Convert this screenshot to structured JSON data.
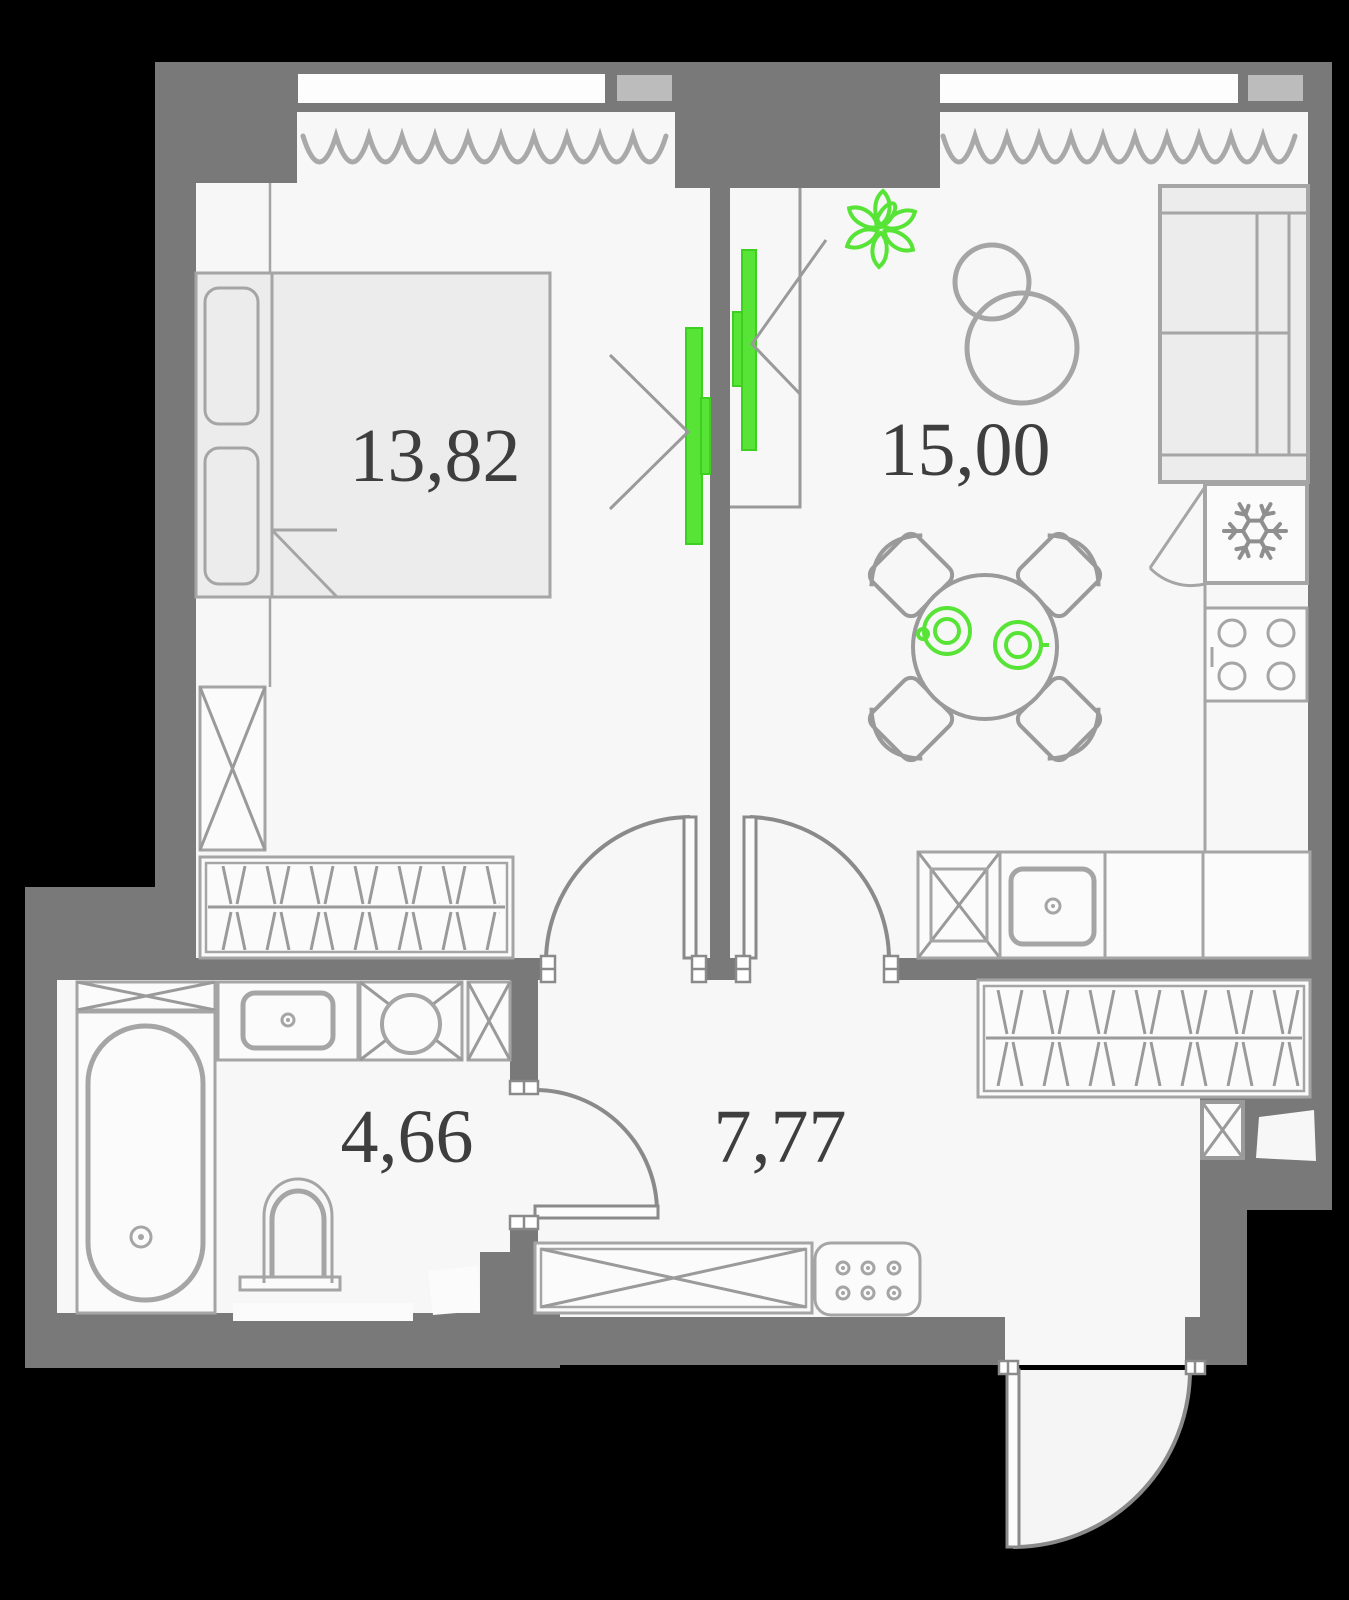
{
  "plan": {
    "type": "apartment-floor-plan",
    "rooms": [
      {
        "name": "bedroom",
        "area": "13,82"
      },
      {
        "name": "living-kitchen",
        "area": "15,00"
      },
      {
        "name": "bathroom",
        "area": "4,66"
      },
      {
        "name": "hallway",
        "area": "7,77"
      }
    ],
    "icons": [
      "plant-icon",
      "snowflake-icon"
    ],
    "colors": {
      "background": "#000000",
      "wall": "#797979",
      "floor": "#f7f7f7",
      "furniture_stroke": "#a5a5a5",
      "accent_green": "#57e436",
      "window_sill": "#bcbcbc",
      "label_text": "#3e3e3e"
    }
  }
}
